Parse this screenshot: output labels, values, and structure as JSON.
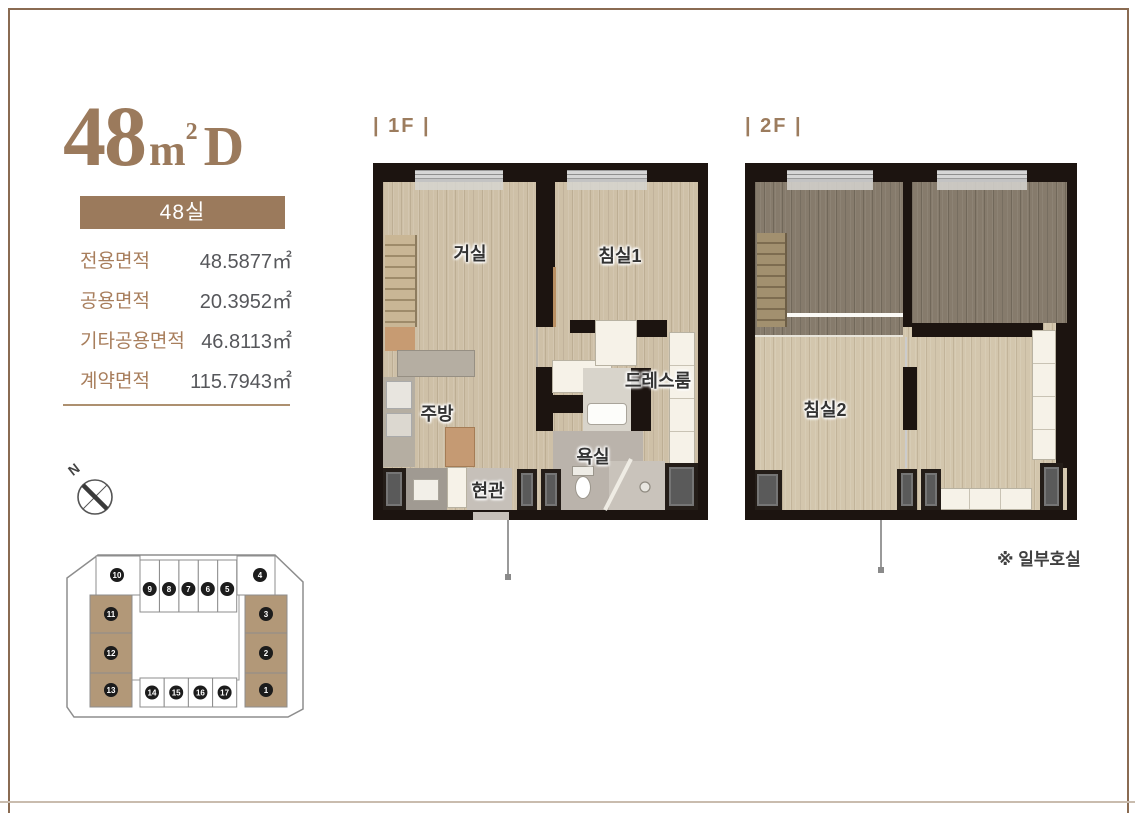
{
  "unit_header": {
    "number": "48",
    "unit": "m",
    "sup": "2",
    "type_letter": "D",
    "badge": "48실"
  },
  "area_table": {
    "rows": [
      {
        "label": "전용면적",
        "value": "48.5877㎡"
      },
      {
        "label": "공용면적",
        "value": "20.3952㎡"
      },
      {
        "label": "기타공용면적",
        "value": "46.8113㎡"
      },
      {
        "label": "계약면적",
        "value": "115.7943㎡"
      }
    ]
  },
  "compass": {
    "north_label": "N"
  },
  "site_plan": {
    "highlight_color": "#b29878",
    "units": [
      {
        "no": "1",
        "highlighted": true
      },
      {
        "no": "2",
        "highlighted": true
      },
      {
        "no": "3",
        "highlighted": true
      },
      {
        "no": "4",
        "highlighted": false
      },
      {
        "no": "5",
        "highlighted": false
      },
      {
        "no": "6",
        "highlighted": false
      },
      {
        "no": "7",
        "highlighted": false
      },
      {
        "no": "8",
        "highlighted": false
      },
      {
        "no": "9",
        "highlighted": false
      },
      {
        "no": "10",
        "highlighted": false
      },
      {
        "no": "11",
        "highlighted": true
      },
      {
        "no": "12",
        "highlighted": true
      },
      {
        "no": "13",
        "highlighted": true
      },
      {
        "no": "14",
        "highlighted": false
      },
      {
        "no": "15",
        "highlighted": false
      },
      {
        "no": "16",
        "highlighted": false
      },
      {
        "no": "17",
        "highlighted": false
      }
    ]
  },
  "floors": [
    {
      "label": "| 1F |",
      "rooms": {
        "living": "거실",
        "bedroom1": "침실1",
        "dressroom": "드레스룸",
        "kitchen": "주방",
        "bath": "욕실",
        "entrance": "현관"
      }
    },
    {
      "label": "| 2F |",
      "rooms": {
        "bedroom2": "침실2"
      }
    }
  ],
  "note": "※ 일부호실",
  "colors": {
    "accent": "#9b7a5c",
    "wall": "#1c1410",
    "border": "#8a6b52"
  }
}
